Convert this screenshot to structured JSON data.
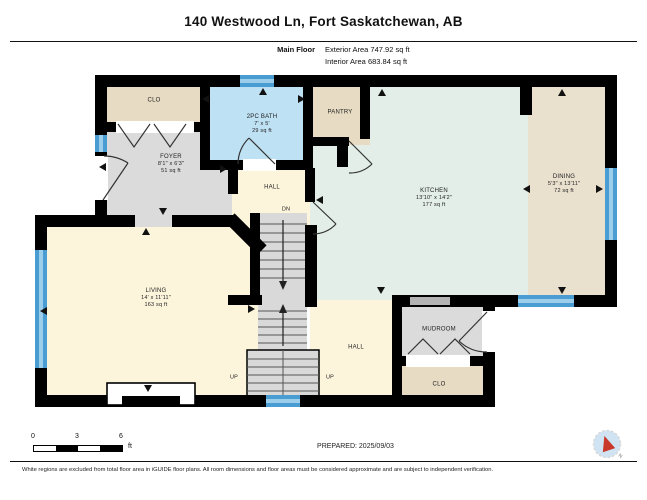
{
  "header": {
    "title": "140 Westwood Ln, Fort Saskatchewan, AB",
    "floor_label": "Main Floor",
    "exterior_area": "Exterior Area 747.92 sq ft",
    "interior_area": "Interior Area 683.84 sq ft"
  },
  "rooms": {
    "clo_top": {
      "name": "CLO",
      "color": "#e7dcc3"
    },
    "bath": {
      "name": "2PC BATH",
      "dims": "7' x 5'",
      "area": "29 sq ft",
      "color": "#bfe1f4"
    },
    "pantry": {
      "name": "PANTRY",
      "color": "#e7dcc3"
    },
    "kitchen": {
      "name": "KITCHEN",
      "dims": "13'10\" x 14'2\"",
      "area": "177 sq ft",
      "color": "#e2eee7"
    },
    "dining": {
      "name": "DINING",
      "dims": "5'3\" x 13'11\"",
      "area": "72 sq ft",
      "color": "#eae0ce"
    },
    "foyer": {
      "name": "FOYER",
      "dims": "8'1\" x 6'3\"",
      "area": "51 sq ft",
      "color": "#dbdbdb"
    },
    "hall_upper": {
      "name": "HALL",
      "color": "#fcf5dc"
    },
    "living": {
      "name": "LIVING",
      "dims": "14' x 11'11\"",
      "area": "163 sq ft",
      "color": "#fcf5dc"
    },
    "hall_lower": {
      "name": "HALL",
      "color": "#fcf5dc"
    },
    "mudroom": {
      "name": "MUDROOM",
      "color": "#dbdbdb"
    },
    "clo_bottom": {
      "name": "CLO",
      "color": "#e7dcc3"
    }
  },
  "stairs": {
    "dn": "DN",
    "up_left": "UP",
    "up_right": "UP",
    "color": "#d9d9d9"
  },
  "compass": {
    "north_label": "N",
    "needle_color": "#c8392b",
    "face_color": "#cfe3f2"
  },
  "scale_bar": {
    "ticks": [
      "0",
      "3",
      "6"
    ],
    "unit": "ft"
  },
  "footer": {
    "prepared": "PREPARED: 2025/09/03",
    "disclaimer": "White regions are excluded from total floor area in iGUIDE floor plans. All room dimensions and floor areas must be considered approximate and are subject to independent verification."
  },
  "colors": {
    "wall": "#000000",
    "window": "#4a9dd2",
    "window_light": "#9ccdea",
    "door": "#333333",
    "opening": "#b3b3b3"
  }
}
